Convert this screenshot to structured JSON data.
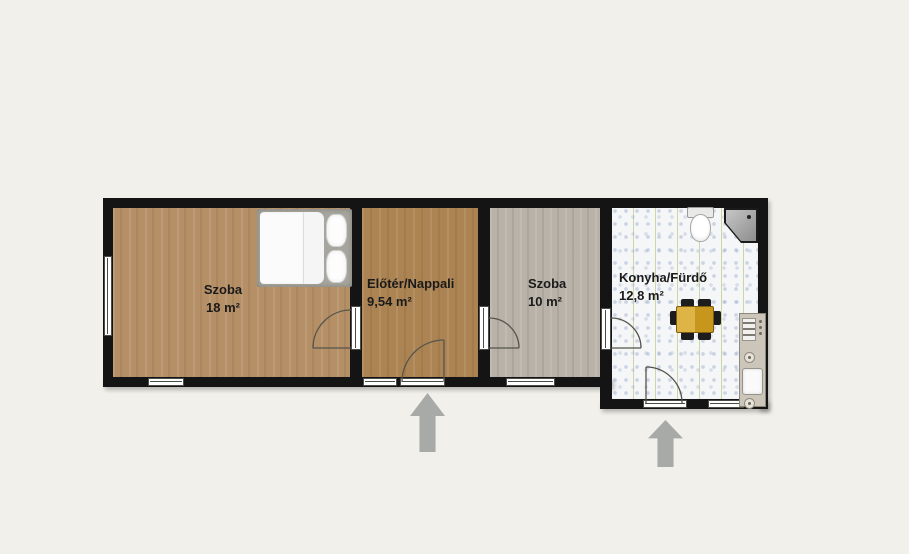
{
  "colors": {
    "background": "#f2f0ea",
    "wall": "#141414",
    "wood_light": "#b59067",
    "wood_warm": "#ac8454",
    "wood_gray": "#b8b2a8",
    "tile_base": "#f5f6f8",
    "arrow": "#a7aaa7",
    "table": "#d8a31f",
    "chair": "#1d1d1d",
    "label": "#1a1a1a"
  },
  "rooms": [
    {
      "name": "Szoba",
      "area": "18 m²"
    },
    {
      "name": "Előtér/Nappali",
      "area": "9,54 m²"
    },
    {
      "name": "Szoba",
      "area": "10 m²"
    },
    {
      "name": "Konyha/Fürdő",
      "area": "12,8 m²"
    }
  ],
  "fixtures": {
    "bed": "double-bed",
    "toilet": "toilet",
    "shower": "corner-shower",
    "dining_table": "dining-table",
    "kitchen_unit": "kitchen-unit-with-sink-and-stove"
  },
  "entrances": [
    "main-entrance-arrow",
    "kitchen-entrance-arrow"
  ]
}
